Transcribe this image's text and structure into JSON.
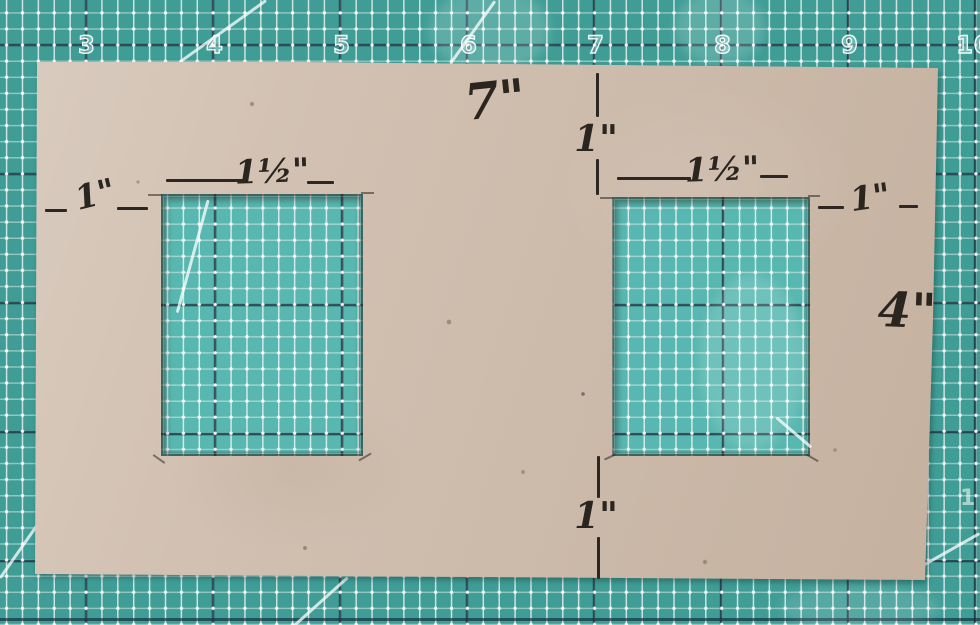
{
  "scene": {
    "description": "Hand-cut cardboard template with two rectangular windows, marked up with pen dimensions, lying on a teal self-healing cutting mat"
  },
  "mat": {
    "ruler_numbers": [
      "3",
      "4",
      "5",
      "6",
      "7",
      "8",
      "9",
      "10"
    ],
    "side_number": "1",
    "base_color": "#3f9d96",
    "window_mat_color": "#58b7b0",
    "grid_line_color": "#ffffff",
    "inch_line_color": "#15303d"
  },
  "cardboard": {
    "color": "#cfbdae",
    "ink_color": "#2b2520"
  },
  "annotations": {
    "total_width": "7\"",
    "top_margin": "1\"",
    "left_window_width": "1½\"",
    "left_margin": "1\"",
    "right_window_width": "1½\"",
    "right_margin": "1\"",
    "total_height": "4\"",
    "bottom_margin": "1\""
  }
}
